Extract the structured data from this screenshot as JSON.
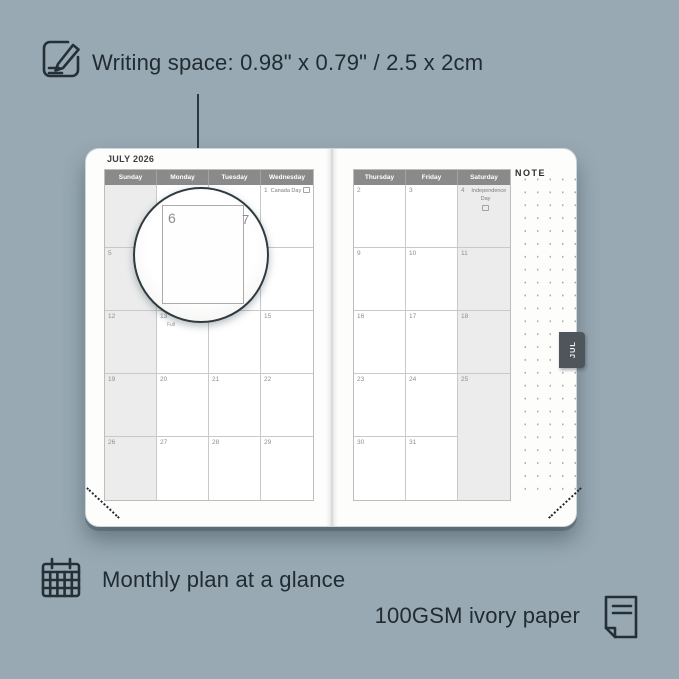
{
  "colors": {
    "background": "#98A9B3",
    "ink": "#212B32",
    "page": "#FDFDFC",
    "header_bar": "#8A8A8A",
    "shaded_column": "#ECECEC",
    "tab_bg": "#4E555B"
  },
  "callouts": {
    "writing_space": "Writing space: 0.98\" x 0.79\" / 2.5 x 2cm",
    "monthly_plan": "Monthly plan at a glance",
    "paper": "100GSM ivory paper"
  },
  "icons": {
    "writing": "notepad-pencil-icon",
    "monthly": "calendar-grid-icon",
    "paper": "paper-sheet-icon",
    "holiday_marker": "flag-box-icon"
  },
  "magnifier": {
    "day": "6",
    "adjacent_day": "7"
  },
  "planner": {
    "month_title": "JULY 2026",
    "tab_label": "JUL",
    "note_label": "NOTE",
    "left_headers": [
      "Sunday",
      "Monday",
      "Tuesday",
      "Wednesday"
    ],
    "right_headers": [
      "Thursday",
      "Friday",
      "Saturday"
    ],
    "left_rows": [
      [
        {
          "d": ""
        },
        {
          "d": ""
        },
        {
          "d": ""
        },
        {
          "d": "1",
          "n": "Canada Day"
        }
      ],
      [
        {
          "d": "5"
        },
        {
          "d": "6"
        },
        {
          "d": "7"
        },
        {
          "d": "8"
        }
      ],
      [
        {
          "d": "12"
        },
        {
          "d": "13",
          "n": "Full"
        },
        {
          "d": "14"
        },
        {
          "d": "15"
        }
      ],
      [
        {
          "d": "19"
        },
        {
          "d": "20"
        },
        {
          "d": "21"
        },
        {
          "d": "22"
        }
      ],
      [
        {
          "d": "26"
        },
        {
          "d": "27"
        },
        {
          "d": "28"
        },
        {
          "d": "29"
        }
      ]
    ],
    "right_rows": [
      [
        {
          "d": "2"
        },
        {
          "d": "3"
        },
        {
          "d": "4",
          "n": "Independence Day"
        }
      ],
      [
        {
          "d": "9"
        },
        {
          "d": "10"
        },
        {
          "d": "11"
        }
      ],
      [
        {
          "d": "16"
        },
        {
          "d": "17"
        },
        {
          "d": "18"
        }
      ],
      [
        {
          "d": "23"
        },
        {
          "d": "24"
        },
        {
          "d": "25"
        }
      ],
      [
        {
          "d": "30"
        },
        {
          "d": "31"
        },
        {
          "d": ""
        }
      ]
    ]
  }
}
